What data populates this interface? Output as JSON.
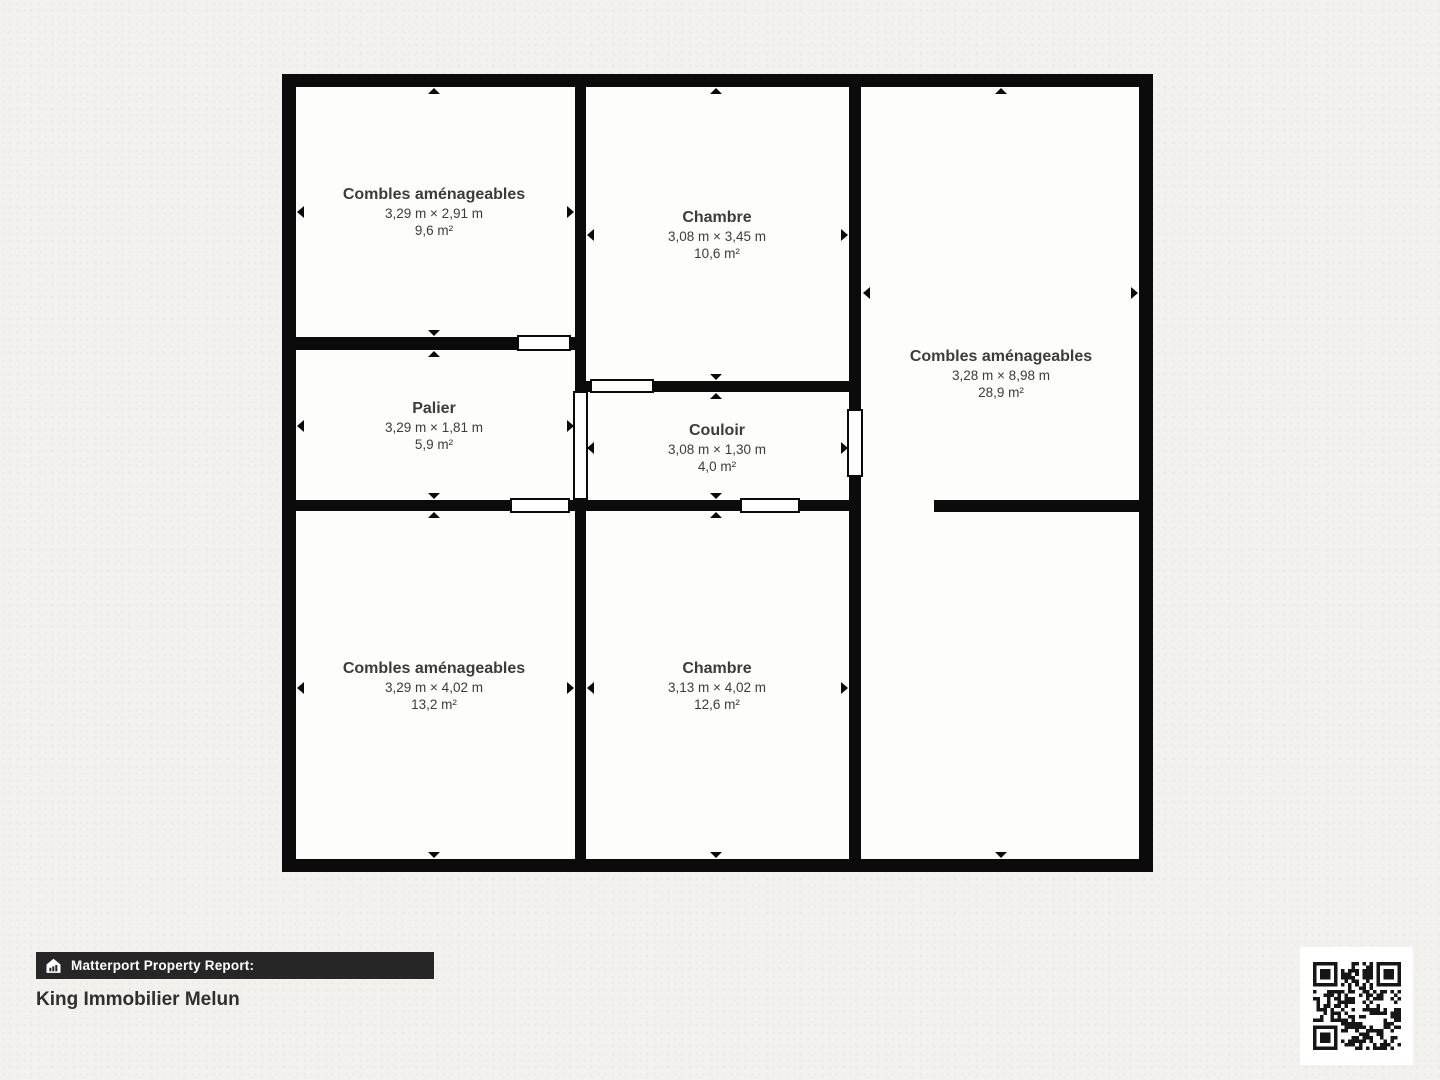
{
  "plan": {
    "rooms": [
      {
        "name": "Combles aménageables",
        "dims": "3,29 m × 2,91 m",
        "area": "9,6 m²"
      },
      {
        "name": "Chambre",
        "dims": "3,08 m × 3,45 m",
        "area": "10,6 m²"
      },
      {
        "name": "Combles aménageables",
        "dims": "3,28 m × 8,98 m",
        "area": "28,9 m²"
      },
      {
        "name": "Palier",
        "dims": "3,29 m × 1,81 m",
        "area": "5,9 m²"
      },
      {
        "name": "Couloir",
        "dims": "3,08 m × 1,30 m",
        "area": "4,0 m²"
      },
      {
        "name": "Combles aménageables",
        "dims": "3,29 m × 4,02 m",
        "area": "13,2 m²"
      },
      {
        "name": "Chambre",
        "dims": "3,13 m × 4,02 m",
        "area": "12,6 m²"
      }
    ]
  },
  "footer": {
    "report_label": "Matterport Property Report:",
    "client_name": "King Immobilier Melun"
  },
  "icons": {
    "logo": "matterport-house-icon",
    "qr": "qr-code"
  },
  "colors": {
    "wall": "#0b0b0b",
    "background": "#f2f1ee",
    "room_fill": "#fdfdfc",
    "text": "#3c3c3c",
    "footer_bar": "#262626"
  }
}
